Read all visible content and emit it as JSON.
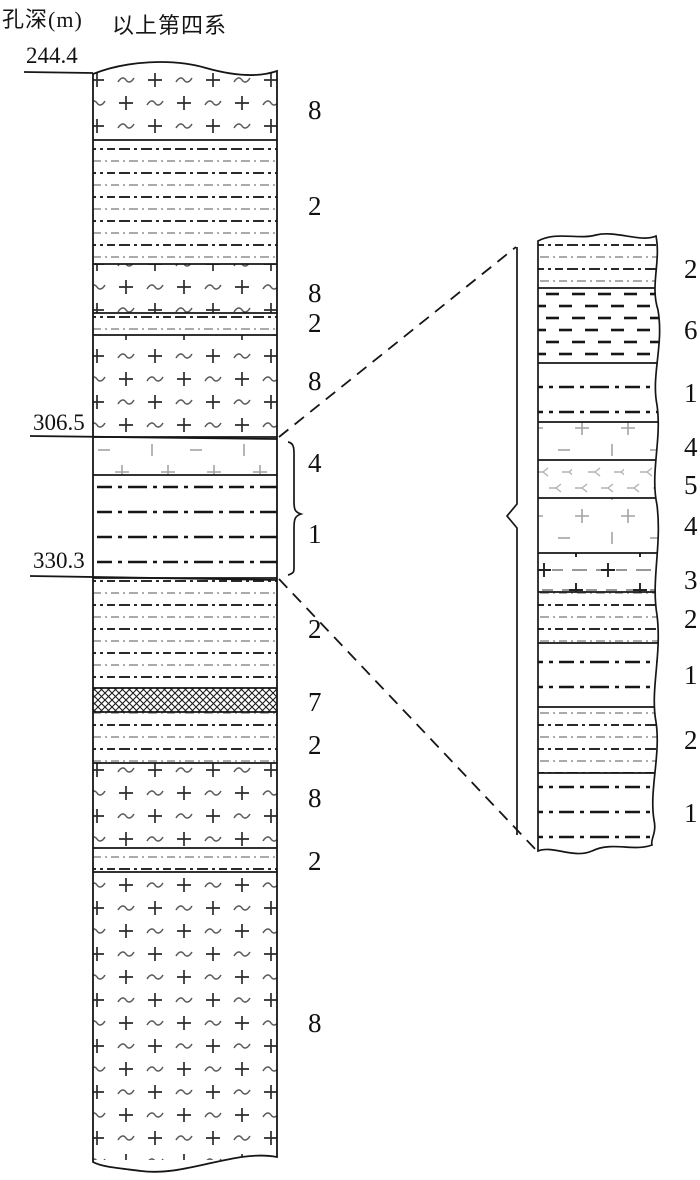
{
  "header": {
    "depth_label": "孔深(m)",
    "quaternary_label": "以上第四系"
  },
  "colors": {
    "ink": "#161616",
    "mid_gray": "#555555",
    "light_gray": "#a6a6a6",
    "background": "#ffffff"
  },
  "depth_markers": [
    {
      "value": "244.4",
      "text_x": 26,
      "text_y": 63,
      "line_x1": 24,
      "line_y1": 72,
      "line_x2": 93,
      "line_y2": 73
    },
    {
      "value": "306.5",
      "text_x": 33,
      "text_y": 430,
      "line_x1": 30,
      "line_y1": 436,
      "line_x2": 277,
      "line_y2": 439
    },
    {
      "value": "330.3",
      "text_x": 33,
      "text_y": 568,
      "line_x1": 30,
      "line_y1": 576,
      "line_x2": 277,
      "line_y2": 580
    }
  ],
  "main_column": {
    "x": 93,
    "width": 184,
    "label_x": 308,
    "layers": [
      {
        "label": "8",
        "pattern": "plus-tilde",
        "top": 72,
        "bottom": 140,
        "label_y": 109
      },
      {
        "label": "2",
        "pattern": "dashdot-fine",
        "top": 140,
        "bottom": 264,
        "label_y": 205
      },
      {
        "label": "8",
        "pattern": "plus-tilde",
        "top": 264,
        "bottom": 313,
        "label_y": 292
      },
      {
        "label": "2",
        "pattern": "dashdot-fine",
        "top": 313,
        "bottom": 335,
        "label_y": 322
      },
      {
        "label": "8",
        "pattern": "plus-tilde",
        "top": 335,
        "bottom": 437,
        "label_y": 380
      },
      {
        "label": "4",
        "pattern": "sparse-plus",
        "top": 437,
        "bottom": 475,
        "label_y": 462
      },
      {
        "label": "1",
        "pattern": "dashdot-bold",
        "top": 475,
        "bottom": 578,
        "label_y": 533
      },
      {
        "label": "2",
        "pattern": "dashdot-fine",
        "top": 578,
        "bottom": 688,
        "label_y": 628
      },
      {
        "label": "7",
        "pattern": "crosshatch",
        "top": 688,
        "bottom": 712,
        "label_y": 701
      },
      {
        "label": "2",
        "pattern": "dashdot-fine",
        "top": 712,
        "bottom": 763,
        "label_y": 744
      },
      {
        "label": "8",
        "pattern": "plus-tilde",
        "top": 763,
        "bottom": 848,
        "label_y": 797
      },
      {
        "label": "2",
        "pattern": "dashdot-fine",
        "top": 848,
        "bottom": 872,
        "label_y": 860
      },
      {
        "label": "8",
        "pattern": "plus-tilde",
        "top": 872,
        "bottom": 1160,
        "label_y": 1022
      }
    ]
  },
  "detail_column": {
    "x": 538,
    "width": 118,
    "label_x": 684,
    "layers": [
      {
        "label": "2",
        "pattern": "dashdot-fine",
        "top": 238,
        "bottom": 288,
        "label_y": 268
      },
      {
        "label": "6",
        "pattern": "dashes-bold",
        "top": 288,
        "bottom": 363,
        "label_y": 329
      },
      {
        "label": "1",
        "pattern": "dashdot-bold",
        "top": 363,
        "bottom": 422,
        "label_y": 392
      },
      {
        "label": "4",
        "pattern": "sparse-plus",
        "top": 422,
        "bottom": 460,
        "label_y": 446
      },
      {
        "label": "5",
        "pattern": "y-glyph",
        "top": 460,
        "bottom": 498,
        "label_y": 484
      },
      {
        "label": "4",
        "pattern": "sparse-plus",
        "top": 498,
        "bottom": 553,
        "label_y": 525
      },
      {
        "label": "3",
        "pattern": "dash-plus",
        "top": 553,
        "bottom": 592,
        "label_y": 579
      },
      {
        "label": "2",
        "pattern": "dashdot-fine",
        "top": 592,
        "bottom": 643,
        "label_y": 618
      },
      {
        "label": "1",
        "pattern": "dashdot-bold",
        "top": 643,
        "bottom": 707,
        "label_y": 674
      },
      {
        "label": "2",
        "pattern": "dashdot-fine",
        "top": 707,
        "bottom": 773,
        "label_y": 739
      },
      {
        "label": "1",
        "pattern": "dashdot-bold",
        "top": 773,
        "bottom": 850,
        "label_y": 812
      }
    ]
  },
  "connectors": {
    "upper_dashed": {
      "x1": 279,
      "y1": 437,
      "x2": 516,
      "y2": 247
    },
    "lower_dashed": {
      "x1": 279,
      "y1": 579,
      "x2": 537,
      "y2": 851
    }
  }
}
